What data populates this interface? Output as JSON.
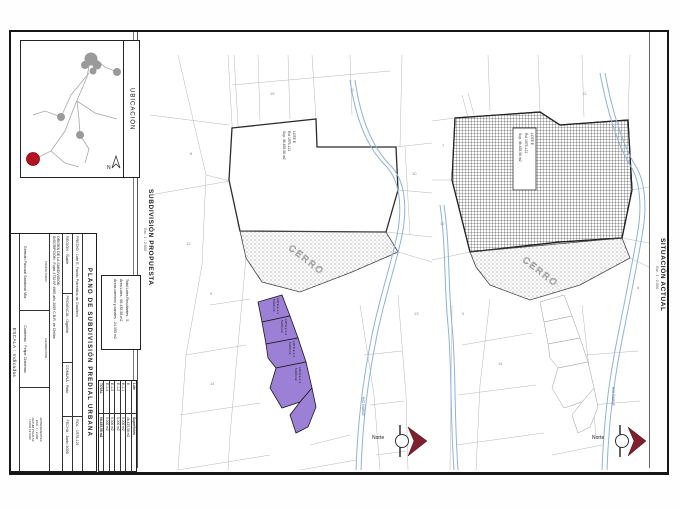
{
  "inset": {
    "title": "UBICACIÓN",
    "north_symbol": "N"
  },
  "captions": {
    "proposed_title": "SUBDIVISIÓN PROPUESTA",
    "proposed_scale": "Esc. 1 : 2.000",
    "current_title": "SITUACIÓN ACTUAL",
    "current_scale": "Esc. 1 : 2.000"
  },
  "title_block": {
    "title": "PLANO DE SUBDIVISIÓN PREDIAL URBANA",
    "predio": "PREDIO : Lote E, Fundo Potrerillos de Gualleco",
    "rol": "ROL : 1975-121",
    "region": "REGIÓN : Ñuble",
    "provincia": "PROVINCIA : Diguillín",
    "comuna": "COMUNA : Pinto",
    "fecha": "FECHA : Junio 2005",
    "origen": "ORIGEN DE LA SUBDIVISIÓN",
    "inscripcion": "INSCRIPCIÓN : Fojas 4732 Nº 4985 año 2005 C.B.R. de Chillán",
    "owner_role": "PROPIETARIO :",
    "owner_name": "Germán Pascual Sandoval Vila",
    "surveyor_role": "GEOMENSOR :",
    "surveyor_name": "Contreras · Felipe Cisternas",
    "notes": [
      "ANTECEDENTES",
      "ESC. 1 : 2.000",
      "DATUM PSAD-56",
      "HUSO 19 SUR"
    ],
    "escala": "ESCALA : Indicadas"
  },
  "summary": {
    "line1": "Total Lotes Resultantes : 5",
    "line2": "Área Lotes : 66.435,58 m2",
    "line3": "Áreas caminos y canales : 24.193 m2"
  },
  "surfaces": {
    "col_lote": "Lote",
    "col_sup": "Superficies",
    "rows": [
      {
        "lote": "E",
        "sup": "46.435,58 m2"
      },
      {
        "lote": "E-1-1",
        "sup": "5.000 m2"
      },
      {
        "lote": "E-1-2",
        "sup": "5.000 m2"
      },
      {
        "lote": "E-1-3",
        "sup": "5.000 m2"
      },
      {
        "lote": "E-1-4",
        "sup": "5.000 m2"
      }
    ],
    "total_label": "TOTAL",
    "total_value": "66.435,58 m2"
  },
  "maps": {
    "proposed": {
      "lote_line1": "LOTE E",
      "lote_line2": "Rol 1975-121",
      "lote_line3": "Sup. 46.435,58 m2",
      "cerro": "CERRO",
      "river": "RÍO ÑUBLE",
      "road": "CAMINO",
      "north": "Norte",
      "lots": [
        {
          "name": "LOTE E-1-1",
          "area": "5.000 m2"
        },
        {
          "name": "LOTE E-1-2",
          "area": "5.000 m2"
        },
        {
          "name": "LOTE E-1-3",
          "area": "5.000 m2"
        },
        {
          "name": "LOTE E-1-4",
          "area": "5.000 m2"
        }
      ],
      "parcel_numbers": [
        "8",
        "12",
        "9",
        "15",
        "11",
        "10",
        "13",
        "14"
      ]
    },
    "current": {
      "lote_line1": "LOTE E",
      "lote_line2": "Rol 1975-121",
      "lote_line3": "Sup. 46.435,58 m2",
      "cerro": "CERRO",
      "river": "RÍO ÑUBLE",
      "road": "CAMINO",
      "north": "Norte",
      "parcel_numbers": [
        "7",
        "10",
        "12",
        "9",
        "14",
        "8"
      ]
    }
  },
  "colors": {
    "purple": "#9c80d6",
    "north_red": "#7d1f2d",
    "river_blue": "#8fb3d8",
    "location_red": "#b5121f"
  }
}
